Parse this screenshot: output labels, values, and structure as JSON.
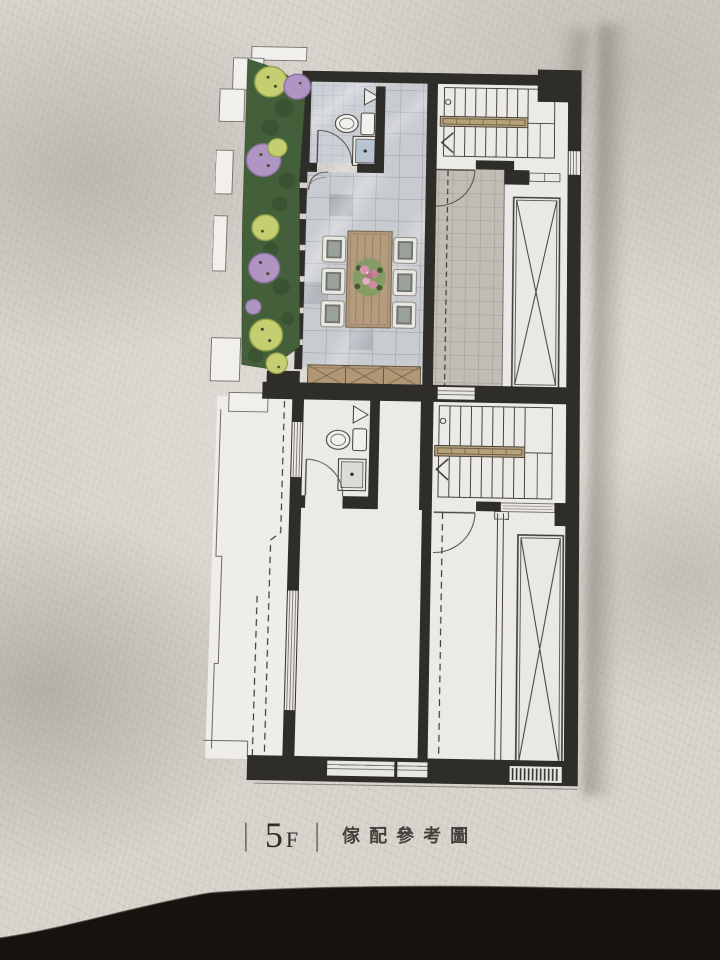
{
  "caption": {
    "floor_number": "5",
    "floor_suffix": "F",
    "separator": "|",
    "title": "傢配參考圖"
  },
  "palette": {
    "paper": "#d6d2cb",
    "plan_floor": "#eceae6",
    "walls": "#2f2d2a",
    "terrace_tile": "#c8cbd0",
    "bath_tile": "#ccd0d6",
    "corridor_tile": "#c1bcb4",
    "wood_table": "#b49b7d",
    "cabinet": "#b29775",
    "stair_handrail": "#b7a277",
    "garden_foliage": "#44603a",
    "bush_light_green": "#c5cf72",
    "bush_purple": "#b095c2",
    "flower_pink": "#d493a9",
    "table_shadow_band": "#16130f"
  },
  "plan_features": [
    "roof-garden-planter-strip",
    "tiled-terrace-dining-area",
    "dining-table-with-six-chairs",
    "upper-bathroom-toilet-sink-shower",
    "upper-u-shaped-staircase",
    "upper-elevator-shaft",
    "storage-cabinet-row",
    "lower-balcony-strip",
    "lower-bathroom-toilet-sink-shower",
    "lower-u-shaped-staircase",
    "lower-elevator-shaft",
    "ventilation-louver"
  ]
}
